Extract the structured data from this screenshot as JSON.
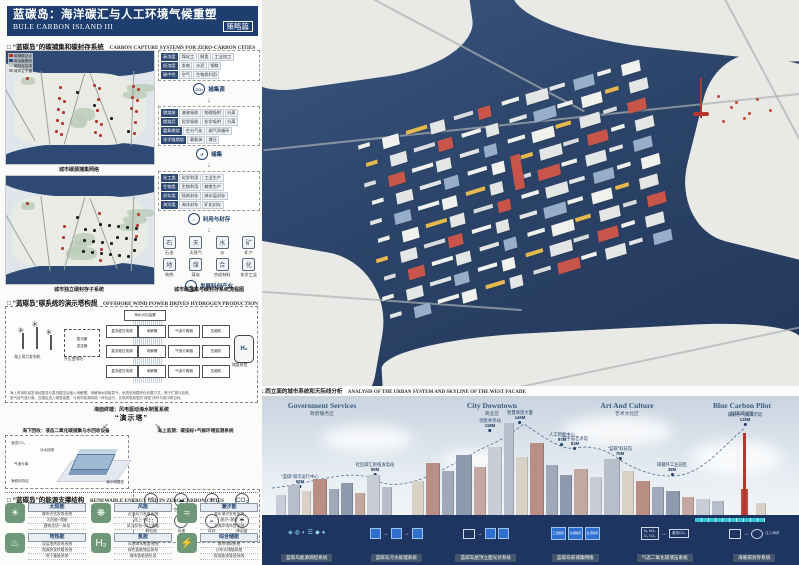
{
  "title": {
    "zh": "蓝碳岛：海洋碳汇与人工环境气候重塑",
    "en": "BULE CARBON ISLAND III",
    "badge": "策略篇"
  },
  "sections": {
    "capture": {
      "zh": "□ “蓝碳岛”的碳捕集和碳封存系统",
      "en": "CARBON CAPTURE SYSTEMS FOR ZERO-CARBON CITIES"
    },
    "tower": {
      "zh": "□ “蓝碳岛”碳系统的演示塔构想",
      "en": "OFFSHORE WIND POWER DRIVES HYDROGEN PRODUCTION"
    },
    "energy": {
      "zh": "□ “蓝碳岛”的能源支撑结构",
      "en": "RENEWABLE ENERGY USE IN ZERO-CARBON CITIES"
    },
    "facade": {
      "zh": "□西立面的城市系统和天际线分析",
      "en": "ANALYSIS OF THE URBAN SYSTEM AND SKYLINE OF THE WEST FACADE"
    }
  },
  "maps": {
    "map1_caption": "城市碳源捕集网络",
    "map2_caption": "城市独立碳封存子系统",
    "legend": [
      {
        "color": "#b03a2e",
        "label": "碳捕集站点"
      },
      {
        "color": "#2e4a74",
        "label": "碳运输管线"
      },
      {
        "color": "#b9ccb6",
        "label": "碳封存区域"
      },
      {
        "color": "#9aa0a0",
        "label": "城市主干道"
      }
    ]
  },
  "flow": {
    "table1": {
      "rows": [
        [
          "高浓度",
          "煤化工",
          "制氢",
          "工业加工"
        ],
        [
          "低浓度",
          "发电",
          "水泥",
          "钢铁"
        ],
        [
          "碳中性",
          "空气",
          "生物质利用",
          ""
        ]
      ]
    },
    "step1": {
      "icon": "CO₂",
      "label": "捕集源"
    },
    "table2": {
      "rows": [
        [
          "燃烧前",
          "溶液吸收",
          "物理吸附",
          "分离"
        ],
        [
          "燃烧后",
          "化学吸收",
          "化学吸附",
          "分离"
        ],
        [
          "富氧燃烧",
          "空分气化",
          "烟气再循环",
          ""
        ],
        [
          "化学链燃烧",
          "载氧体",
          "增压",
          ""
        ]
      ]
    },
    "step2": {
      "icon": "↺",
      "label": "捕集"
    },
    "table3": {
      "rows": [
        [
          "化工类",
          "化学利用",
          "工业生产"
        ],
        [
          "生物类",
          "生物利用",
          "粮食生产"
        ],
        [
          "封存类",
          "陆地封存",
          "咸水层封存"
        ],
        [
          "海洋类",
          "海洋封存",
          "矿化封存"
        ]
      ]
    },
    "step3": {
      "icon": "⌂",
      "label": "利用与封存"
    },
    "resources": [
      {
        "label": "石油"
      },
      {
        "label": "天然气"
      },
      {
        "label": "水"
      },
      {
        "label": "矿产"
      },
      {
        "label": "地热"
      },
      {
        "label": "煤炭"
      },
      {
        "label": "合成材料"
      },
      {
        "label": "化学工业"
      }
    ],
    "step4": {
      "icon": "✦",
      "label": "发展科创产业"
    },
    "caption": "城市碳捕集与碳封存系统流程图"
  },
  "wind": {
    "turbine_label": "海上风力发电机",
    "station_label": "升压变电站",
    "rectifier": "整流器",
    "inverter": "逆变器",
    "desal": "海水淡化装置",
    "dc_label": "直流稳压电源",
    "elec_label": "电解槽",
    "sep_label": "气液分离器",
    "comp_label": "压缩机",
    "tank": "H₂",
    "tank_label": "储氢装置",
    "note1": "海上风电机组发电经整流与直流稳压后输入电解槽，电解海水制取氢气；系统采用模块化布置方式，便于扩展与检修。",
    "note2": "氢气经气液分离、压缩后进入储氢装置，与城市能源网络一体化运行，实现风电制氢的“绿氢”闭环与碳中和目标。"
  },
  "demo": {
    "surface": "海面终端：风电驱动海水制氢系统",
    "center": "“演示塔”",
    "left_title": "海下回收：液态二氧化碳捕集与水回收设备",
    "right_title": "海上监测：碳指标+气候环境监测系统",
    "left_labels": {
      "l1": "液态CO₂",
      "l2": "淡水回收",
      "l3": "气液分离",
      "l4": "海底封存区",
      "l5": "演示塔模型"
    },
    "monitors": [
      {
        "glyph": "℃",
        "label": "空气温度"
      },
      {
        "glyph": "☁",
        "label": "空气湿度"
      },
      {
        "glyph": "☀",
        "label": "光照度"
      },
      {
        "glyph": "CO₂",
        "label": "CO₂浓度"
      },
      {
        "glyph": "∷",
        "label": "颗粒物"
      },
      {
        "glyph": "✳",
        "label": "风速"
      },
      {
        "glyph": "➢",
        "label": "风向"
      },
      {
        "glyph": "☂",
        "label": "降雨量"
      }
    ]
  },
  "energy": {
    "items": [
      {
        "glyph": "☀",
        "name": "太阳能",
        "lines": [
          "城市光伏发电系统",
          "太阳能+储能",
          "建筑光伏一体化"
        ]
      },
      {
        "glyph": "❋",
        "name": "风能",
        "lines": [
          "近海风力发电系统",
          "陆上+海上",
          "风力发电+风力蓄能"
        ]
      },
      {
        "glyph": "≈",
        "name": "潮汐能",
        "lines": [
          "海水潮汐发电系统",
          "潮汐+潮流",
          "沿海岸线布置系统"
        ]
      },
      {
        "glyph": "♨",
        "name": "地热能",
        "lines": [
          "深层地热发电系统",
          "地源热泵供暖系统",
          "地下蓄能系统"
        ]
      },
      {
        "glyph": "H₂",
        "name": "氢能",
        "lines": [
          "风电海水制氢系统",
          "绿色氢能储运体系",
          "城市氢能源应用"
        ]
      },
      {
        "glyph": "⚡",
        "name": "综合储能",
        "lines": [
          "城市电网系统",
          "分布式储能网络",
          "智慧能源管理系统"
        ]
      }
    ]
  },
  "skyline": {
    "districts": [
      {
        "en": "Government Services",
        "zh": "政府服务区"
      },
      {
        "en": "City Downtown",
        "zh": "商业区"
      },
      {
        "en": "Art And Culture",
        "zh": "艺术文化区"
      },
      {
        "en": "Blue Carbon Pilot",
        "zh": "蓝碳试验区"
      }
    ],
    "buildings": [
      {
        "name": "“蓝碳”城市运行中心",
        "height": "66M"
      },
      {
        "name": "社区碳汇枢纽发电站",
        "height": "89M"
      },
      {
        "name": "创客共享站",
        "height": "118M"
      },
      {
        "name": "智慧商贸大厦",
        "height": "146M"
      },
      {
        "name": "人工智能中心",
        "height": "97M"
      },
      {
        "name": "元宇宙艺术馆",
        "height": "83M"
      },
      {
        "name": "“蓝碳”科技馆",
        "height": "76M"
      },
      {
        "name": "碳循环工业园区",
        "height": "38M"
      },
      {
        "name": "碳封存气候演示塔",
        "height": "128M"
      }
    ],
    "systems": [
      "蓝碳岛能源调控系统",
      "蓝碳岛污水处理系统",
      "蓝碳岛屋顶立面光伏系统",
      "蓝碳岛碳捕集网络",
      "气态二氧化碳液压系统",
      "海底碳封存系统"
    ],
    "strip": {
      "sources": [
        "工业碳源",
        "交通碳源",
        "生活碳源"
      ],
      "gas_top": "N₂  NO₂",
      "gas_bottom": "O₂  CO₂",
      "liquid": "液态CO₂",
      "inject": "注入海床"
    }
  }
}
